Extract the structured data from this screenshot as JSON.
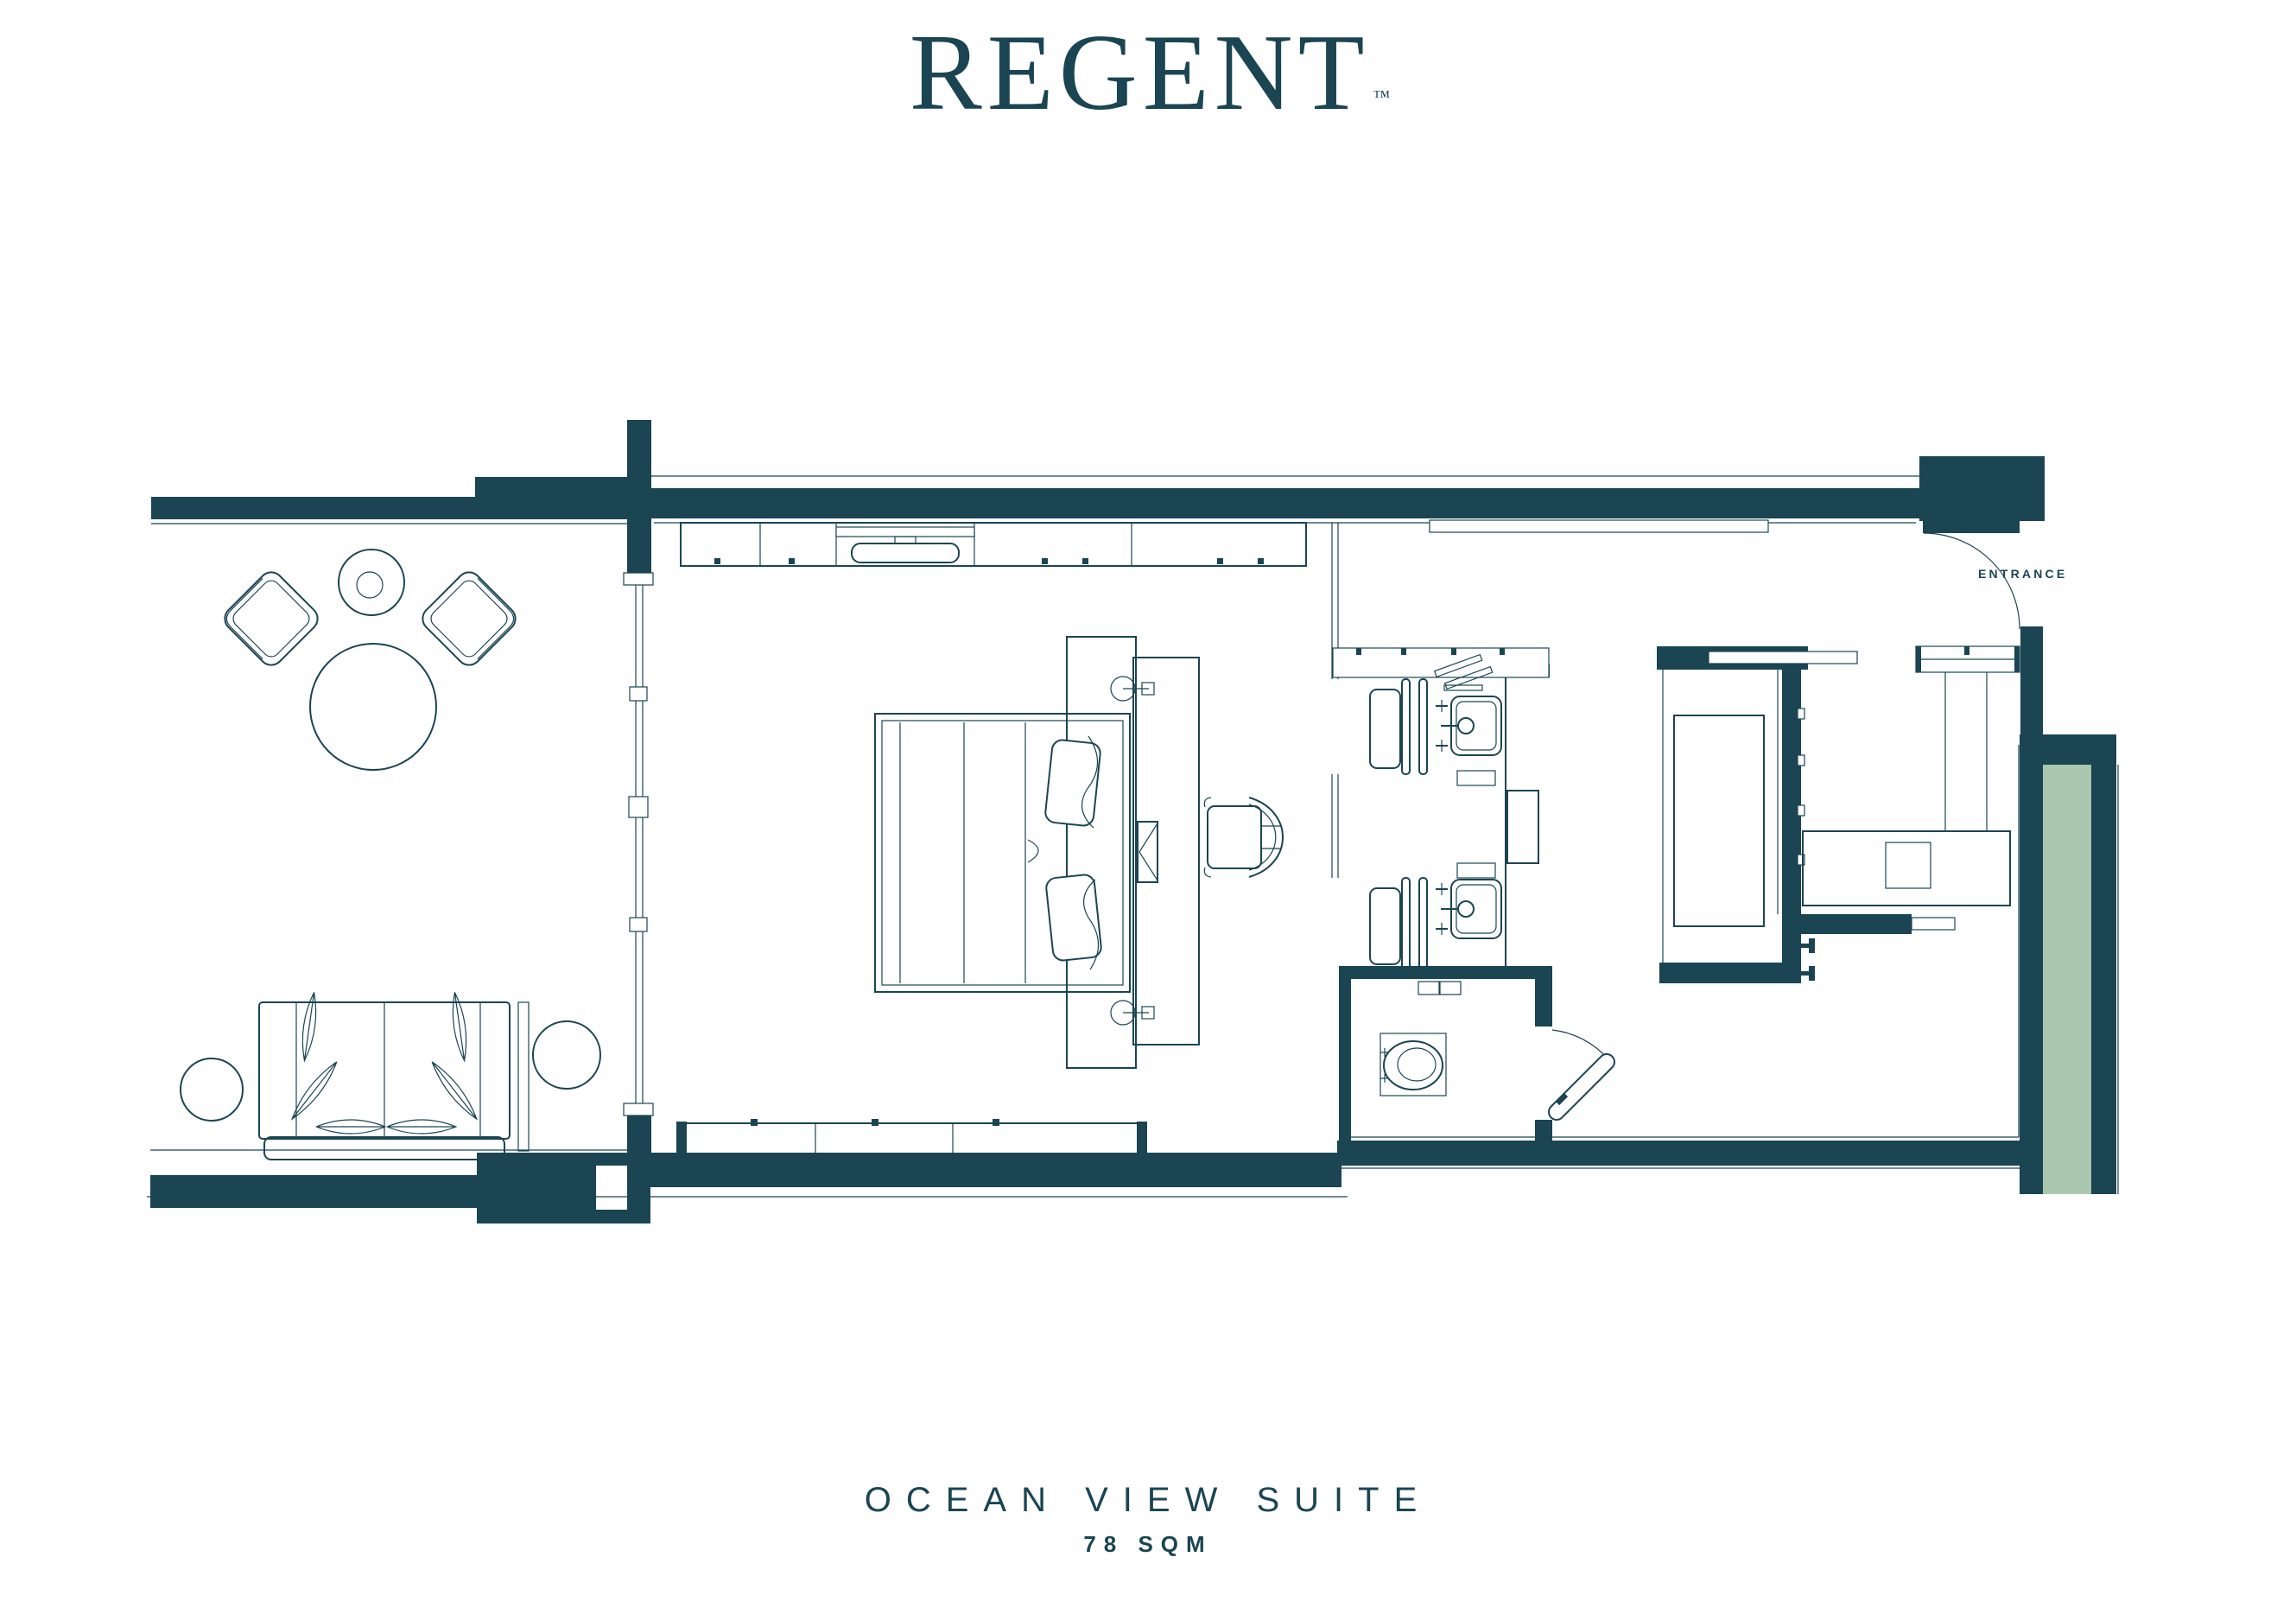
{
  "brand": {
    "logo_text": "REGENT",
    "trademark": "™"
  },
  "plan": {
    "entrance_label": "ENTRANCE"
  },
  "footer": {
    "title": "OCEAN VIEW SUITE",
    "area": "78 SQM"
  },
  "colors": {
    "wall": "#1B4552",
    "accent_green": "#A9C7AE",
    "background": "#FFFFFF"
  }
}
